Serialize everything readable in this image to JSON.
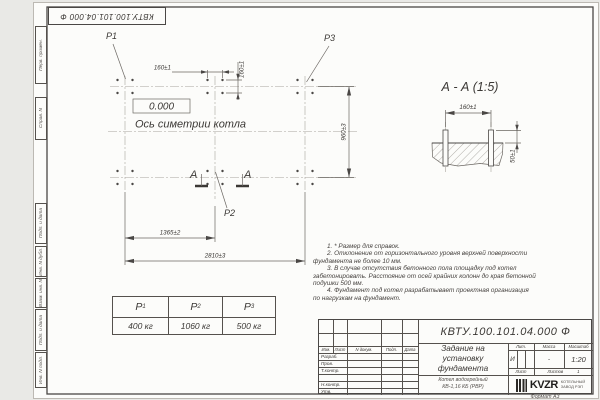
{
  "stamp_top": "КВТУ.100.101.04.000  Ф",
  "margin": [
    "Перв. примен.",
    "Справ. N",
    "Подп. и дата",
    "Инв. N дубл.",
    "Взам. инв. N",
    "Подп. и дата",
    "Инв. N подл."
  ],
  "plan": {
    "elevation": "0.000",
    "symmetry_label": "Ось симетрии котла",
    "p1": "P1",
    "p2": "P2",
    "p3": "P3",
    "cut_letter": "А",
    "dim_bolt_spacing_h": "160±1",
    "dim_bolt_spacing_v": "160±1",
    "dim_row_spacing": "960±3",
    "dim_mid_column": "1365±2",
    "dim_total": "2810±3"
  },
  "section": {
    "title": "А - А (1:5)",
    "dim_spacing": "160±1",
    "dim_height": "50±1"
  },
  "notes": [
    "1. * Размер для справок.",
    "2. Отклонение от горизонтального уровня верхней поверхности",
    "фундамента не более 10 мм.",
    "3. В случае отсутствия бетонного пола площадку под котел",
    "забетонировать. Расстояние от осей крайних колонн до края бетонной",
    "подушки 500 мм.",
    "4. Фундамент под котел разрабатывает проектная организация",
    "по нагрузкам на фундамент."
  ],
  "load_table": {
    "headers": [
      {
        "p": "P",
        "sub": "1"
      },
      {
        "p": "P",
        "sub": "2"
      },
      {
        "p": "P",
        "sub": "3"
      }
    ],
    "values": [
      "400 кг",
      "1060 кг",
      "500 кг"
    ]
  },
  "title_block": {
    "doc_number": "КВТУ.100.101.04.000  Ф",
    "title_line1": "Задание на",
    "title_line2": "установку",
    "title_line3": "фундамента",
    "product_line1": "Котел водогрейный",
    "product_line2": "КВ-1,16 КБ (РВР)",
    "cols": [
      "Изм.",
      "Лист",
      "N докум.",
      "Подп.",
      "Дата"
    ],
    "rows": [
      "Разраб.",
      "Пров.",
      "Т.контр.",
      "Н.контр.",
      "Утв."
    ],
    "lit_label": "Лит.",
    "lit_value": "И",
    "mass_label": "Масса",
    "mass_value": "-",
    "scale_label": "Масштаб",
    "scale_value": "1:20",
    "sheet_label": "Лист",
    "sheets_label": "Листов",
    "sheets_value": "1",
    "logo_text": "KVZR",
    "logo_caption1": "КОТЕЛЬНЫЙ",
    "logo_caption2": "ЗАВОД РЭП",
    "format_label": "Формат А3"
  }
}
